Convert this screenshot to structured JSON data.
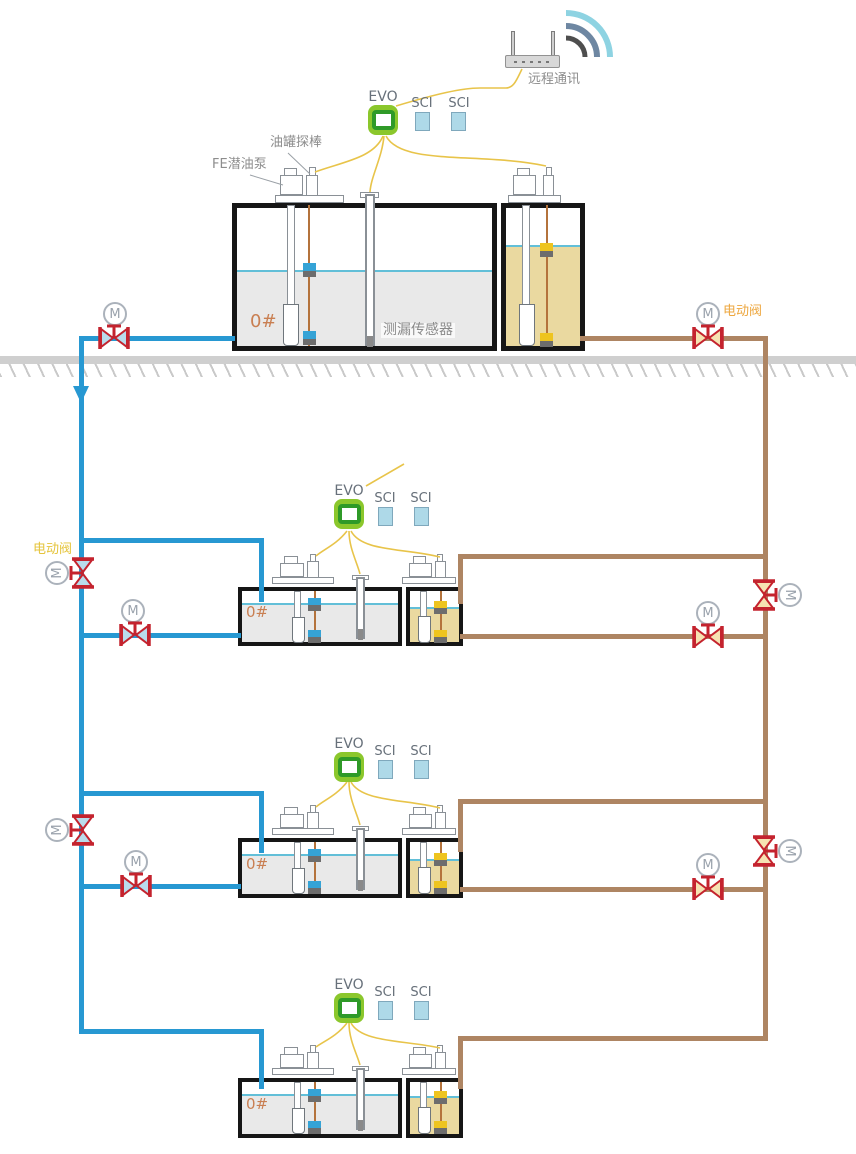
{
  "labels": {
    "remote_comm": "远程通讯",
    "tank_probe": "油罐探棒",
    "submersible_pump": "FE潜油泵",
    "leak_sensor": "测漏传感器",
    "electric_valve": "电动阀",
    "motor": "M"
  },
  "devices": {
    "controller": "EVO",
    "module": "SCI"
  },
  "stations": [
    {
      "fuel_grade": "0#"
    },
    {
      "fuel_grade": "0#"
    },
    {
      "fuel_grade": "0#"
    },
    {
      "fuel_grade": "0#"
    }
  ],
  "colors": {
    "supply_pipe_blue": "#2798d2",
    "return_pipe_brown": "#ae8563",
    "valve_red": "#c4232e",
    "evo_green": "#8bc72c",
    "sci_blue": "#aed9e8",
    "cable_yellow": "#e8c44a",
    "diesel_gray": "#e9e9e9",
    "gasoline_yellow": "#ead9a0",
    "level_line": "#62bfd8"
  }
}
